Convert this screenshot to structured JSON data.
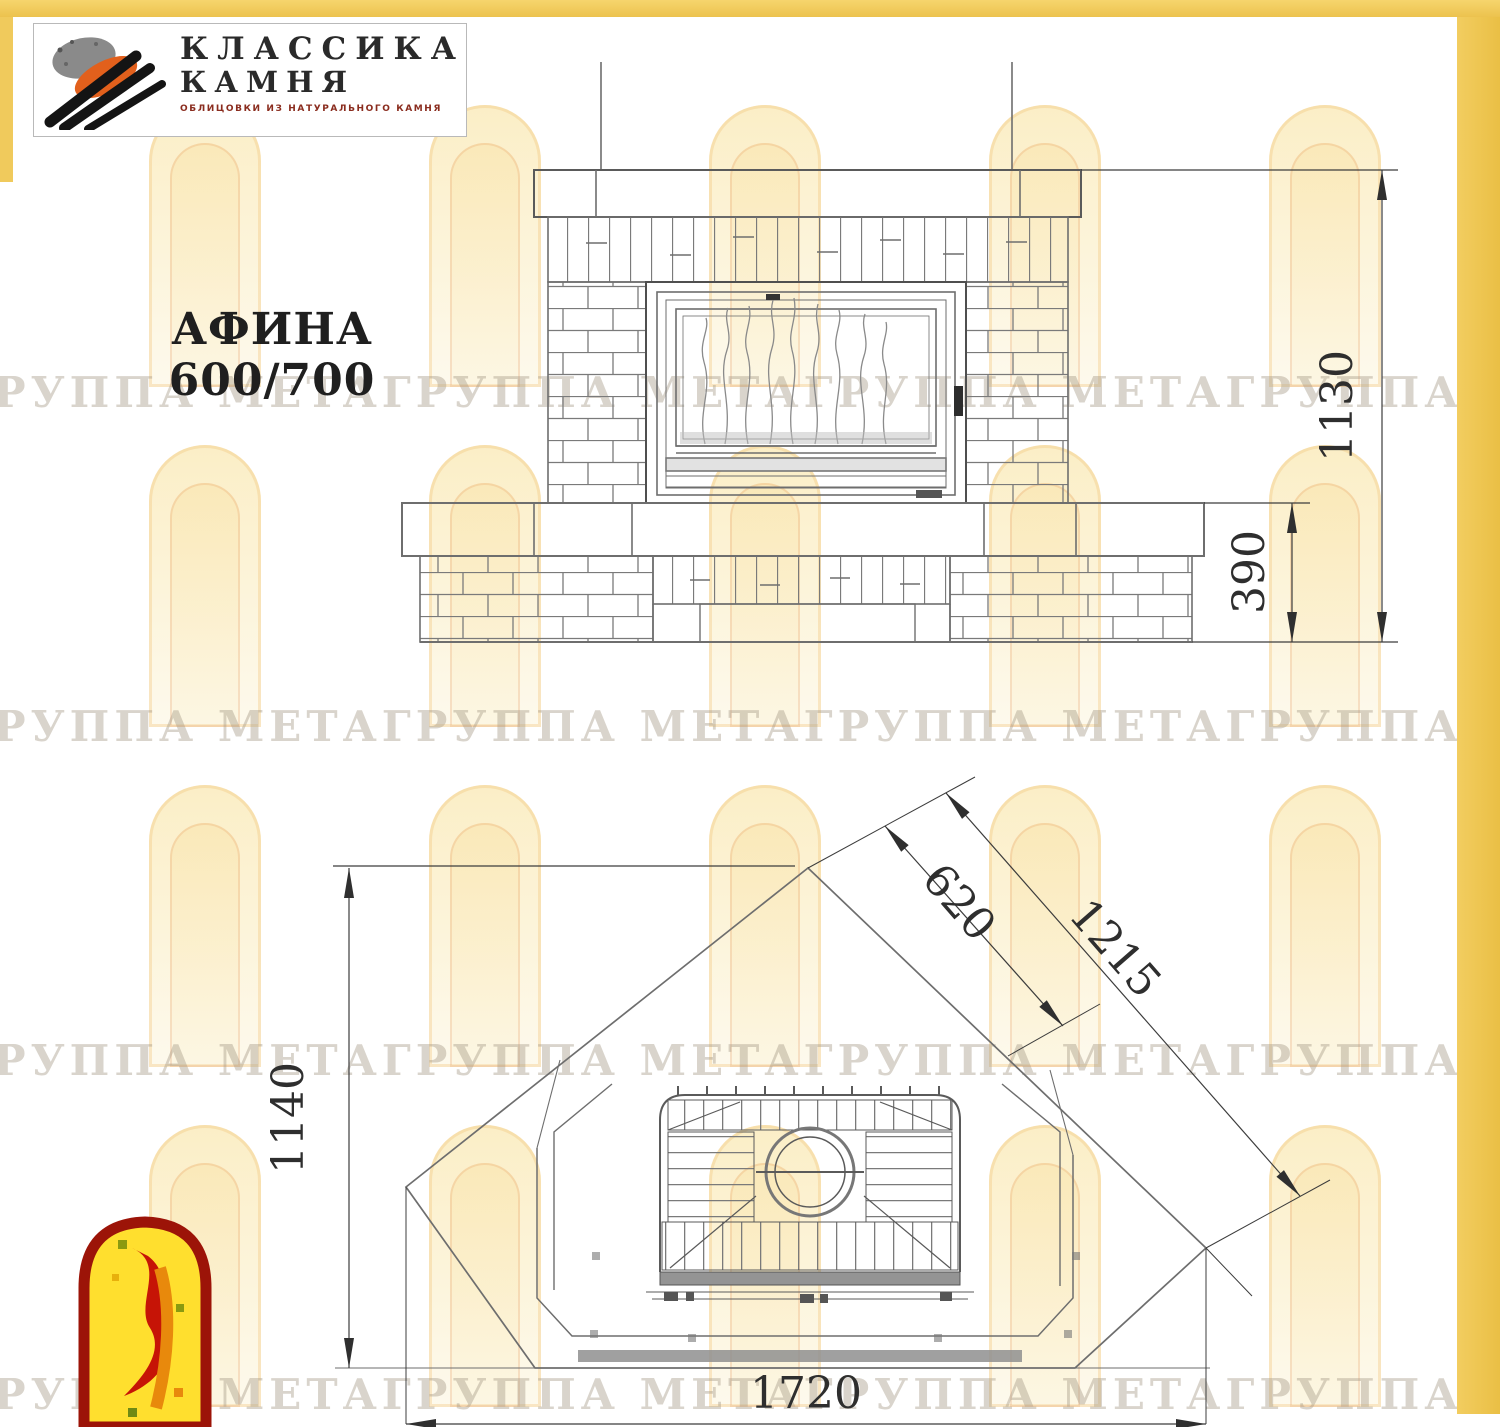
{
  "branding": {
    "company_line1": "КЛАССИКА",
    "company_line2": "КАМНЯ",
    "company_subtitle": "ОБЛИЦОВКИ ИЗ НАТУРАЛЬНОГО КАМНЯ"
  },
  "title": "АФИНА 600/700",
  "watermark": {
    "text": "ГРУППА МЕТА",
    "repeats": 8,
    "text_rows_y": [
      368,
      702,
      1036,
      1370
    ],
    "arch_rows_y": [
      105,
      445,
      785,
      1125
    ],
    "arch_cols_x": [
      149,
      429,
      709,
      989,
      1269
    ]
  },
  "front_view": {
    "description": "front elevation of stone fireplace with fire insert",
    "dims": {
      "total_height": "1130",
      "base_height": "390"
    }
  },
  "plan_view": {
    "description": "corner installation plan view of fireplace",
    "dims": {
      "depth": "1140",
      "width": "1720",
      "inner_diag": "620",
      "outer_diag": "1215"
    }
  },
  "colors": {
    "frame_yellow": "#f0ca5c",
    "logo_stone_orange": "#e2601c",
    "logo_stone_gray": "#8a8a8a",
    "emblem_border_red": "#9c1408",
    "emblem_fill_yellow": "#ffdf2e",
    "emblem_figure_red": "#c61406",
    "drawing_line_gray": "#6e6e6e"
  }
}
